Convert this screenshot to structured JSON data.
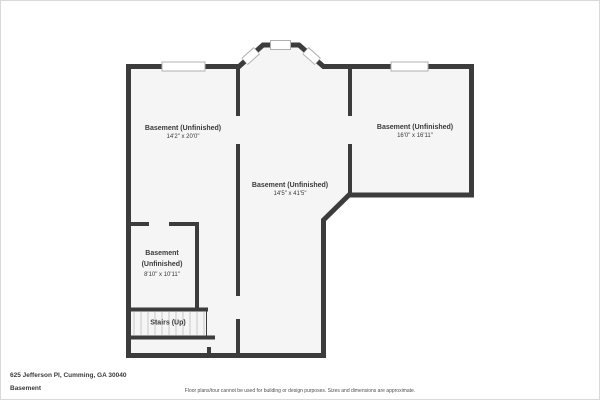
{
  "plan": {
    "rooms": [
      {
        "id": "basement-left",
        "name": "Basement (Unfinished)",
        "dims": "14'2\" x 20'0\""
      },
      {
        "id": "basement-right",
        "name": "Basement (Unfinished)",
        "dims": "16'0\" x 16'11\""
      },
      {
        "id": "basement-center",
        "name": "Basement (Unfinished)",
        "dims": "14'5\" x 41'5\""
      },
      {
        "id": "basement-small",
        "name": "Basement (Unfinished)",
        "dims": "8'10\" x 10'11\""
      }
    ],
    "stairs": {
      "label": "Stairs (Up)"
    }
  },
  "footer": {
    "address": "625 Jefferson Pl, Cumming, GA 30040",
    "floor_name": "Basement",
    "disclaimer": "Floor plans/tour cannot be used for building or design purposes. Sizes and dimensions are approximate."
  },
  "colors": {
    "wall": "#3c3c3c",
    "floor": "#f5f5f5",
    "window_fill": "#ffffff",
    "window_edge": "#b0b0b0",
    "stair_tread": "#c9c9c9",
    "text": "#3a3a3a",
    "muted_text": "#4f4f4f"
  }
}
